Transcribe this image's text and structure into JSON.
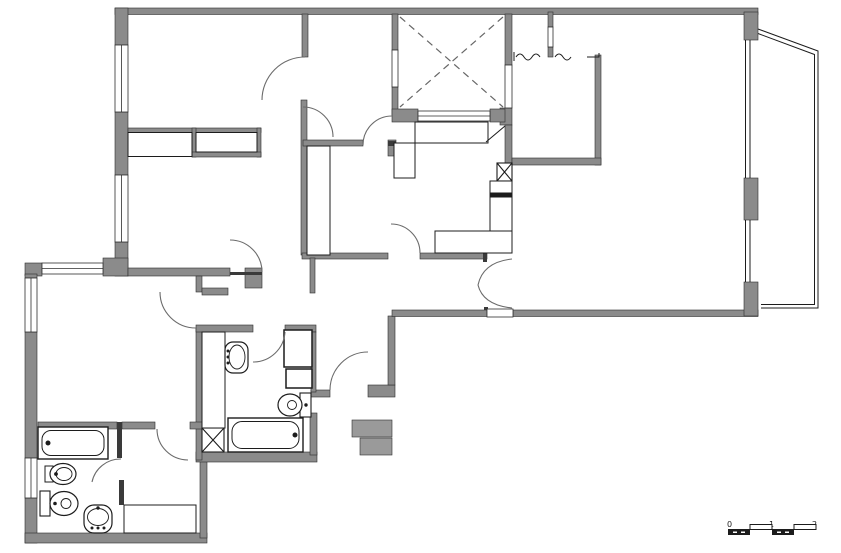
{
  "document": {
    "type": "architectural-floor-plan",
    "title": "Apartment floor plan drawing"
  },
  "scale_bar": {
    "labels": {
      "start": "0",
      "mid": "1",
      "end": "2"
    }
  },
  "palette": {
    "background": "#ffffff",
    "wall_fill": "#8b8b8b",
    "wall_edge": "#2e2e2e",
    "thin_line": "#1c1c1c",
    "door_arc": "#6b6b6b",
    "dashed_shaft": "#666666"
  },
  "features": {
    "shafts": [
      "elevator-shaft-with-x",
      "duct-box-entry",
      "duct-box-bathroom"
    ],
    "stairs": "stair-flight-break-lines",
    "balcony": "angled-terrace-top-right",
    "exterior_steps": "service-entrance-steps"
  },
  "fixtures": [
    "bathtub-main-bathroom",
    "bidet-main-bathroom",
    "toilet-main-bathroom",
    "pedestal-sink-main-bathroom",
    "bathtub-second-bathroom",
    "toilet-second-bathroom",
    "pedestal-sink-second-bathroom"
  ]
}
